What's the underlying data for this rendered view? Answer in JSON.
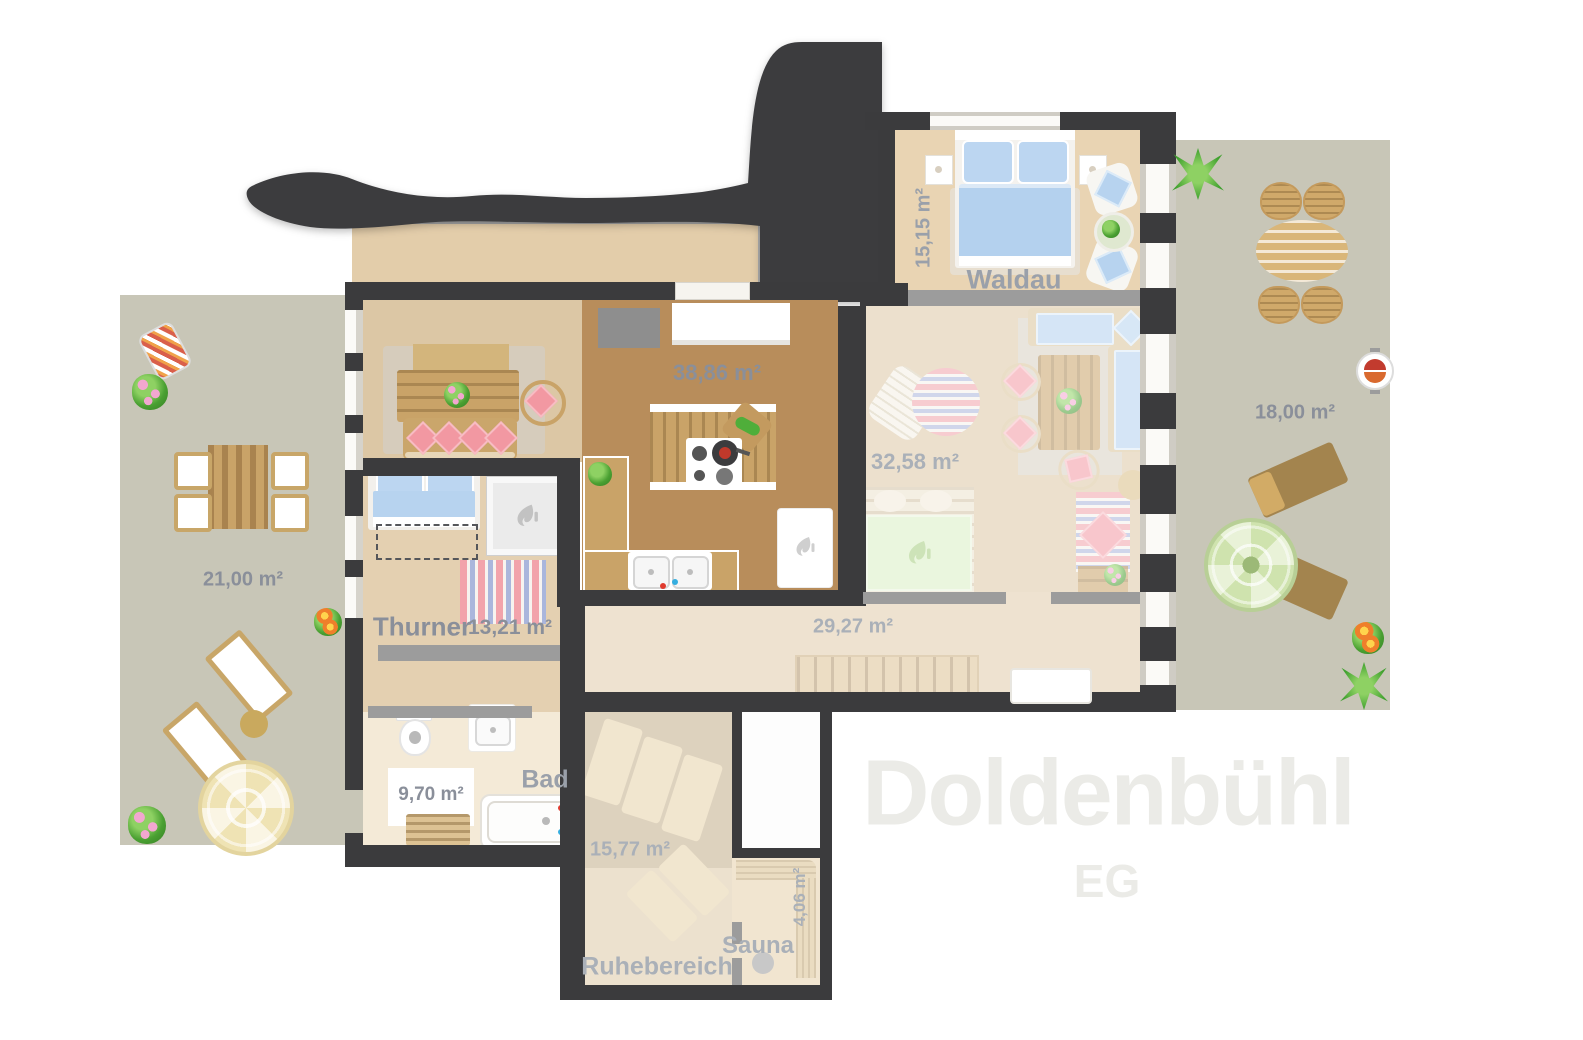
{
  "watermark": {
    "title": "Doldenbühl",
    "floor": "EG"
  },
  "rooms": {
    "waldau": {
      "name": "Waldau",
      "area": "15,15 m²"
    },
    "wohnen_kueche": {
      "area": "38,86 m²"
    },
    "lounge": {
      "area": "32,58 m²"
    },
    "thurner": {
      "name": "Thurner",
      "area": "13,21 m²"
    },
    "flur": {
      "area": "29,27 m²"
    },
    "bad": {
      "name": "Bad",
      "area": "9,70 m²"
    },
    "ruhebereich": {
      "name": "Ruhebereich",
      "area": "15,77 m²"
    },
    "sauna": {
      "name": "Sauna",
      "area": "4,06 m²"
    },
    "terrasse_links": {
      "area": "21,00 m²"
    },
    "terrasse_rechts": {
      "area": "18,00 m²"
    }
  },
  "colors": {
    "wall_dark": "#3b3b3d",
    "partition_gray": "#9c9c9c",
    "terrace": "#c8c6b7",
    "floor_beige": "#dcc7a5",
    "floor_kitchen_brown": "#b88d5b",
    "floor_thurner": "#e4d0b1",
    "floor_waldau": "#e9d4b3",
    "floor_bath": "#f4ead7",
    "bedding_blue": "#b7d3ef",
    "cushion_pink": "#f298a2",
    "wood": "#c9a368",
    "rug_green": "#d9eec3",
    "label_text": "#8a8f9a",
    "label_text_faded": "#aab0b8",
    "watermark_text": "#ebebe7"
  }
}
